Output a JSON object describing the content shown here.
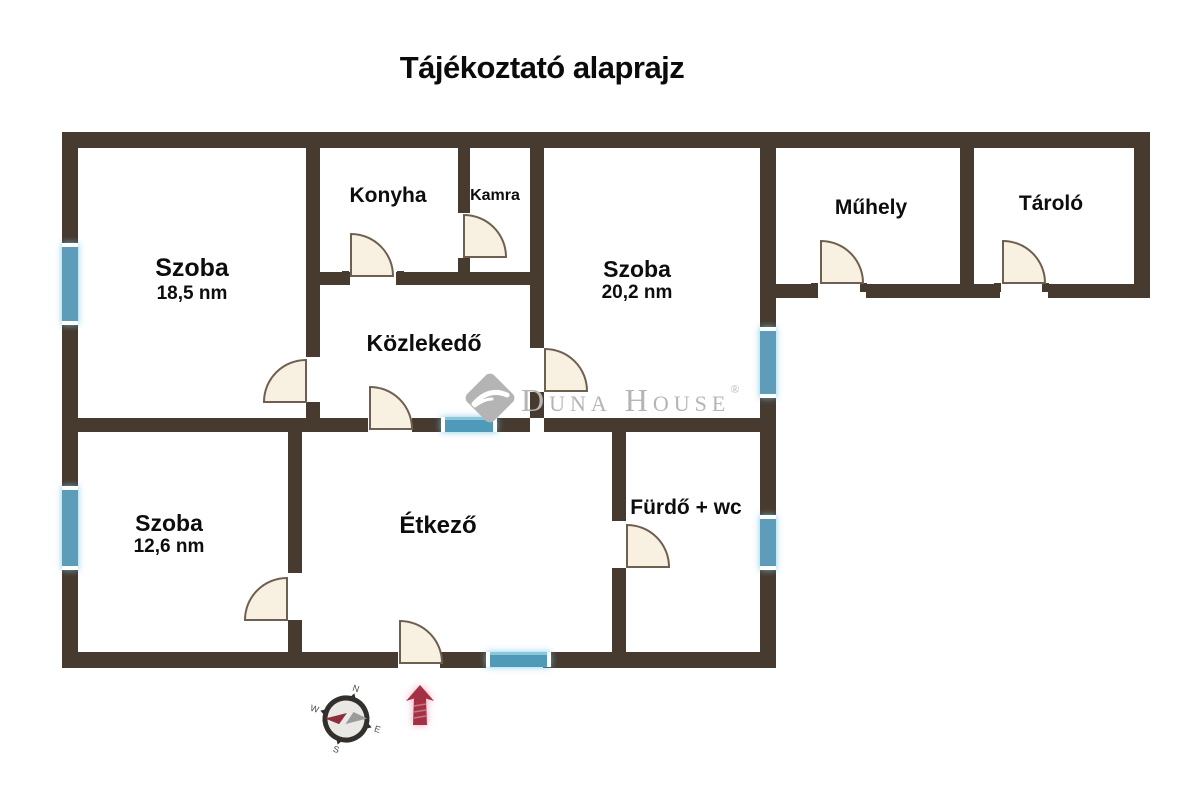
{
  "title": "Tájékoztató alaprajz",
  "watermark": {
    "brand": "Duna House",
    "registered": "®"
  },
  "rooms": [
    {
      "id": "szoba-1",
      "name": "Szoba",
      "area": "18,5 nm"
    },
    {
      "id": "konyha",
      "name": "Konyha",
      "area": ""
    },
    {
      "id": "kamra",
      "name": "Kamra",
      "area": ""
    },
    {
      "id": "szoba-2",
      "name": "Szoba",
      "area": "20,2 nm"
    },
    {
      "id": "muhely",
      "name": "Műhely",
      "area": ""
    },
    {
      "id": "tarolo",
      "name": "Tároló",
      "area": ""
    },
    {
      "id": "kozlekedo",
      "name": "Közlekedő",
      "area": ""
    },
    {
      "id": "szoba-3",
      "name": "Szoba",
      "area": "12,6 nm"
    },
    {
      "id": "etkezo",
      "name": "Étkező",
      "area": ""
    },
    {
      "id": "furdo",
      "name": "Fürdő + wc",
      "area": ""
    }
  ],
  "compass": {
    "n": "N",
    "e": "E",
    "s": "S",
    "w": "W"
  },
  "colors": {
    "wall": "#473a2f",
    "window_blue": "#5d9dba",
    "window_teal": "#4f9ab8",
    "door_fill": "#f8f0e1",
    "door_stroke": "#6e6051",
    "north_arrow_red": "#a53043",
    "logo_gray": "#b5b5b5",
    "text_black": "#0d0d0d"
  }
}
